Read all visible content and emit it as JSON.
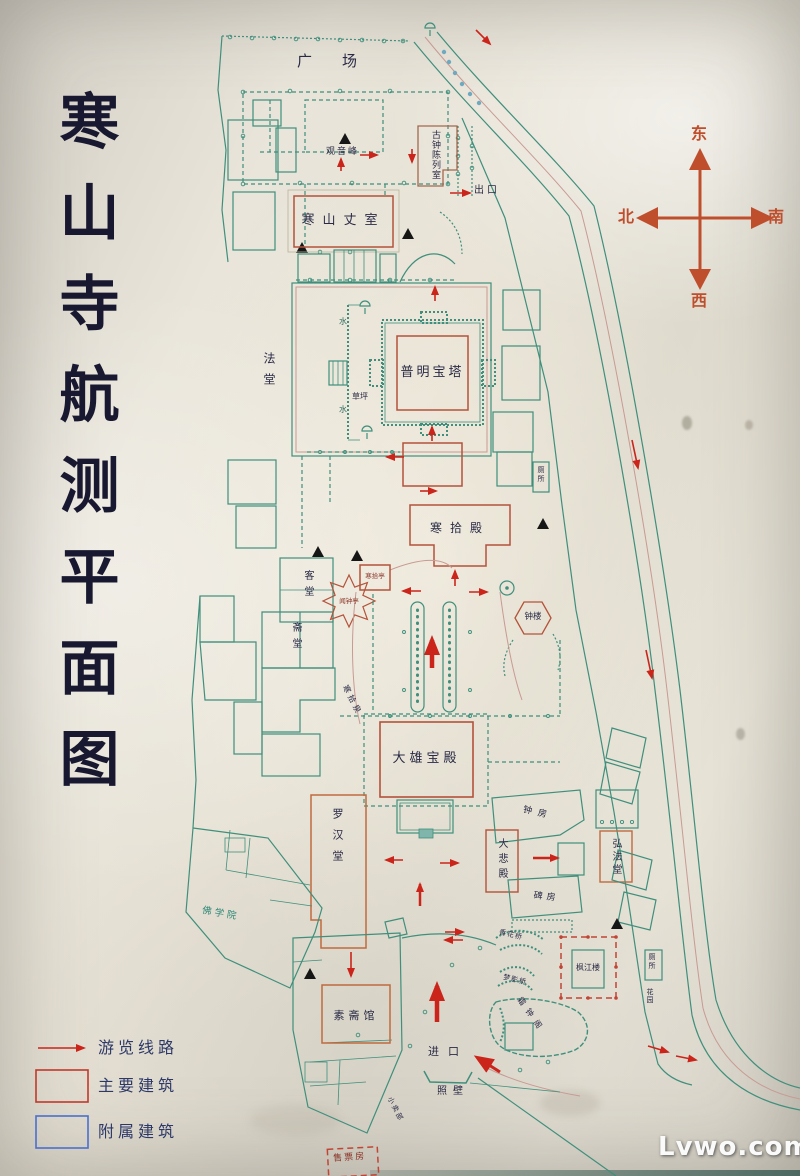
{
  "title": "寒山寺航测平面图",
  "watermark": "Lvwo.com",
  "compass": {
    "east": "东",
    "south": "南",
    "west": "西",
    "north": "北"
  },
  "legend": {
    "route_label": "游览线路",
    "main_label": "主要建筑",
    "aux_label": "附属建筑"
  },
  "labels": {
    "plaza": "广场",
    "guanyin_peak": "观音峰",
    "ancient_bell_room": "古钟陈列室",
    "exit": "出口",
    "hanshan_abbot": "寒山丈室",
    "dharma_hall": "法堂",
    "puming_pagoda": "普明宝塔",
    "lawn": "草坪",
    "water": "水",
    "toilet": "厕所",
    "hanshi_hall": "寒拾殿",
    "guest_hall": "客堂",
    "dining_hall": "斋堂",
    "hanshi_pavilion": "寒拾亭",
    "wenzhong_pavilion": "闻钟亭",
    "bell_tower": "钟楼",
    "hanshi_spring": "寒拾泉",
    "mahavira_hall": "大雄宝殿",
    "arhat_hall": "罗汉堂",
    "dabei_hall": "大悲殿",
    "bell_room": "钟房",
    "stele_room": "碑房",
    "hongfa_hall": "弘法堂",
    "buddhist_academy": "佛学院",
    "veg_restaurant": "素斋馆",
    "entrance": "进口",
    "screen_wall": "照壁",
    "ticket_office": "售票房",
    "fengjiang_tower": "枫江楼",
    "shuangzhong_pavilion": "霜钟阁",
    "xianghua_bridge": "香花桥",
    "mengying_bridge": "梦影桥",
    "garden": "花园",
    "snack_shop": "小卖部"
  },
  "colors": {
    "route_red": "#cb241a",
    "main_building_red": "#b4523a",
    "secondary_orange": "#c06a3f",
    "auxiliary_teal": "#3f8f7c",
    "legend_blue": "#4a6fd0",
    "compass_orange": "#bf4f2c",
    "road_pink": "#c89a92",
    "ink": "#2a2a46"
  }
}
